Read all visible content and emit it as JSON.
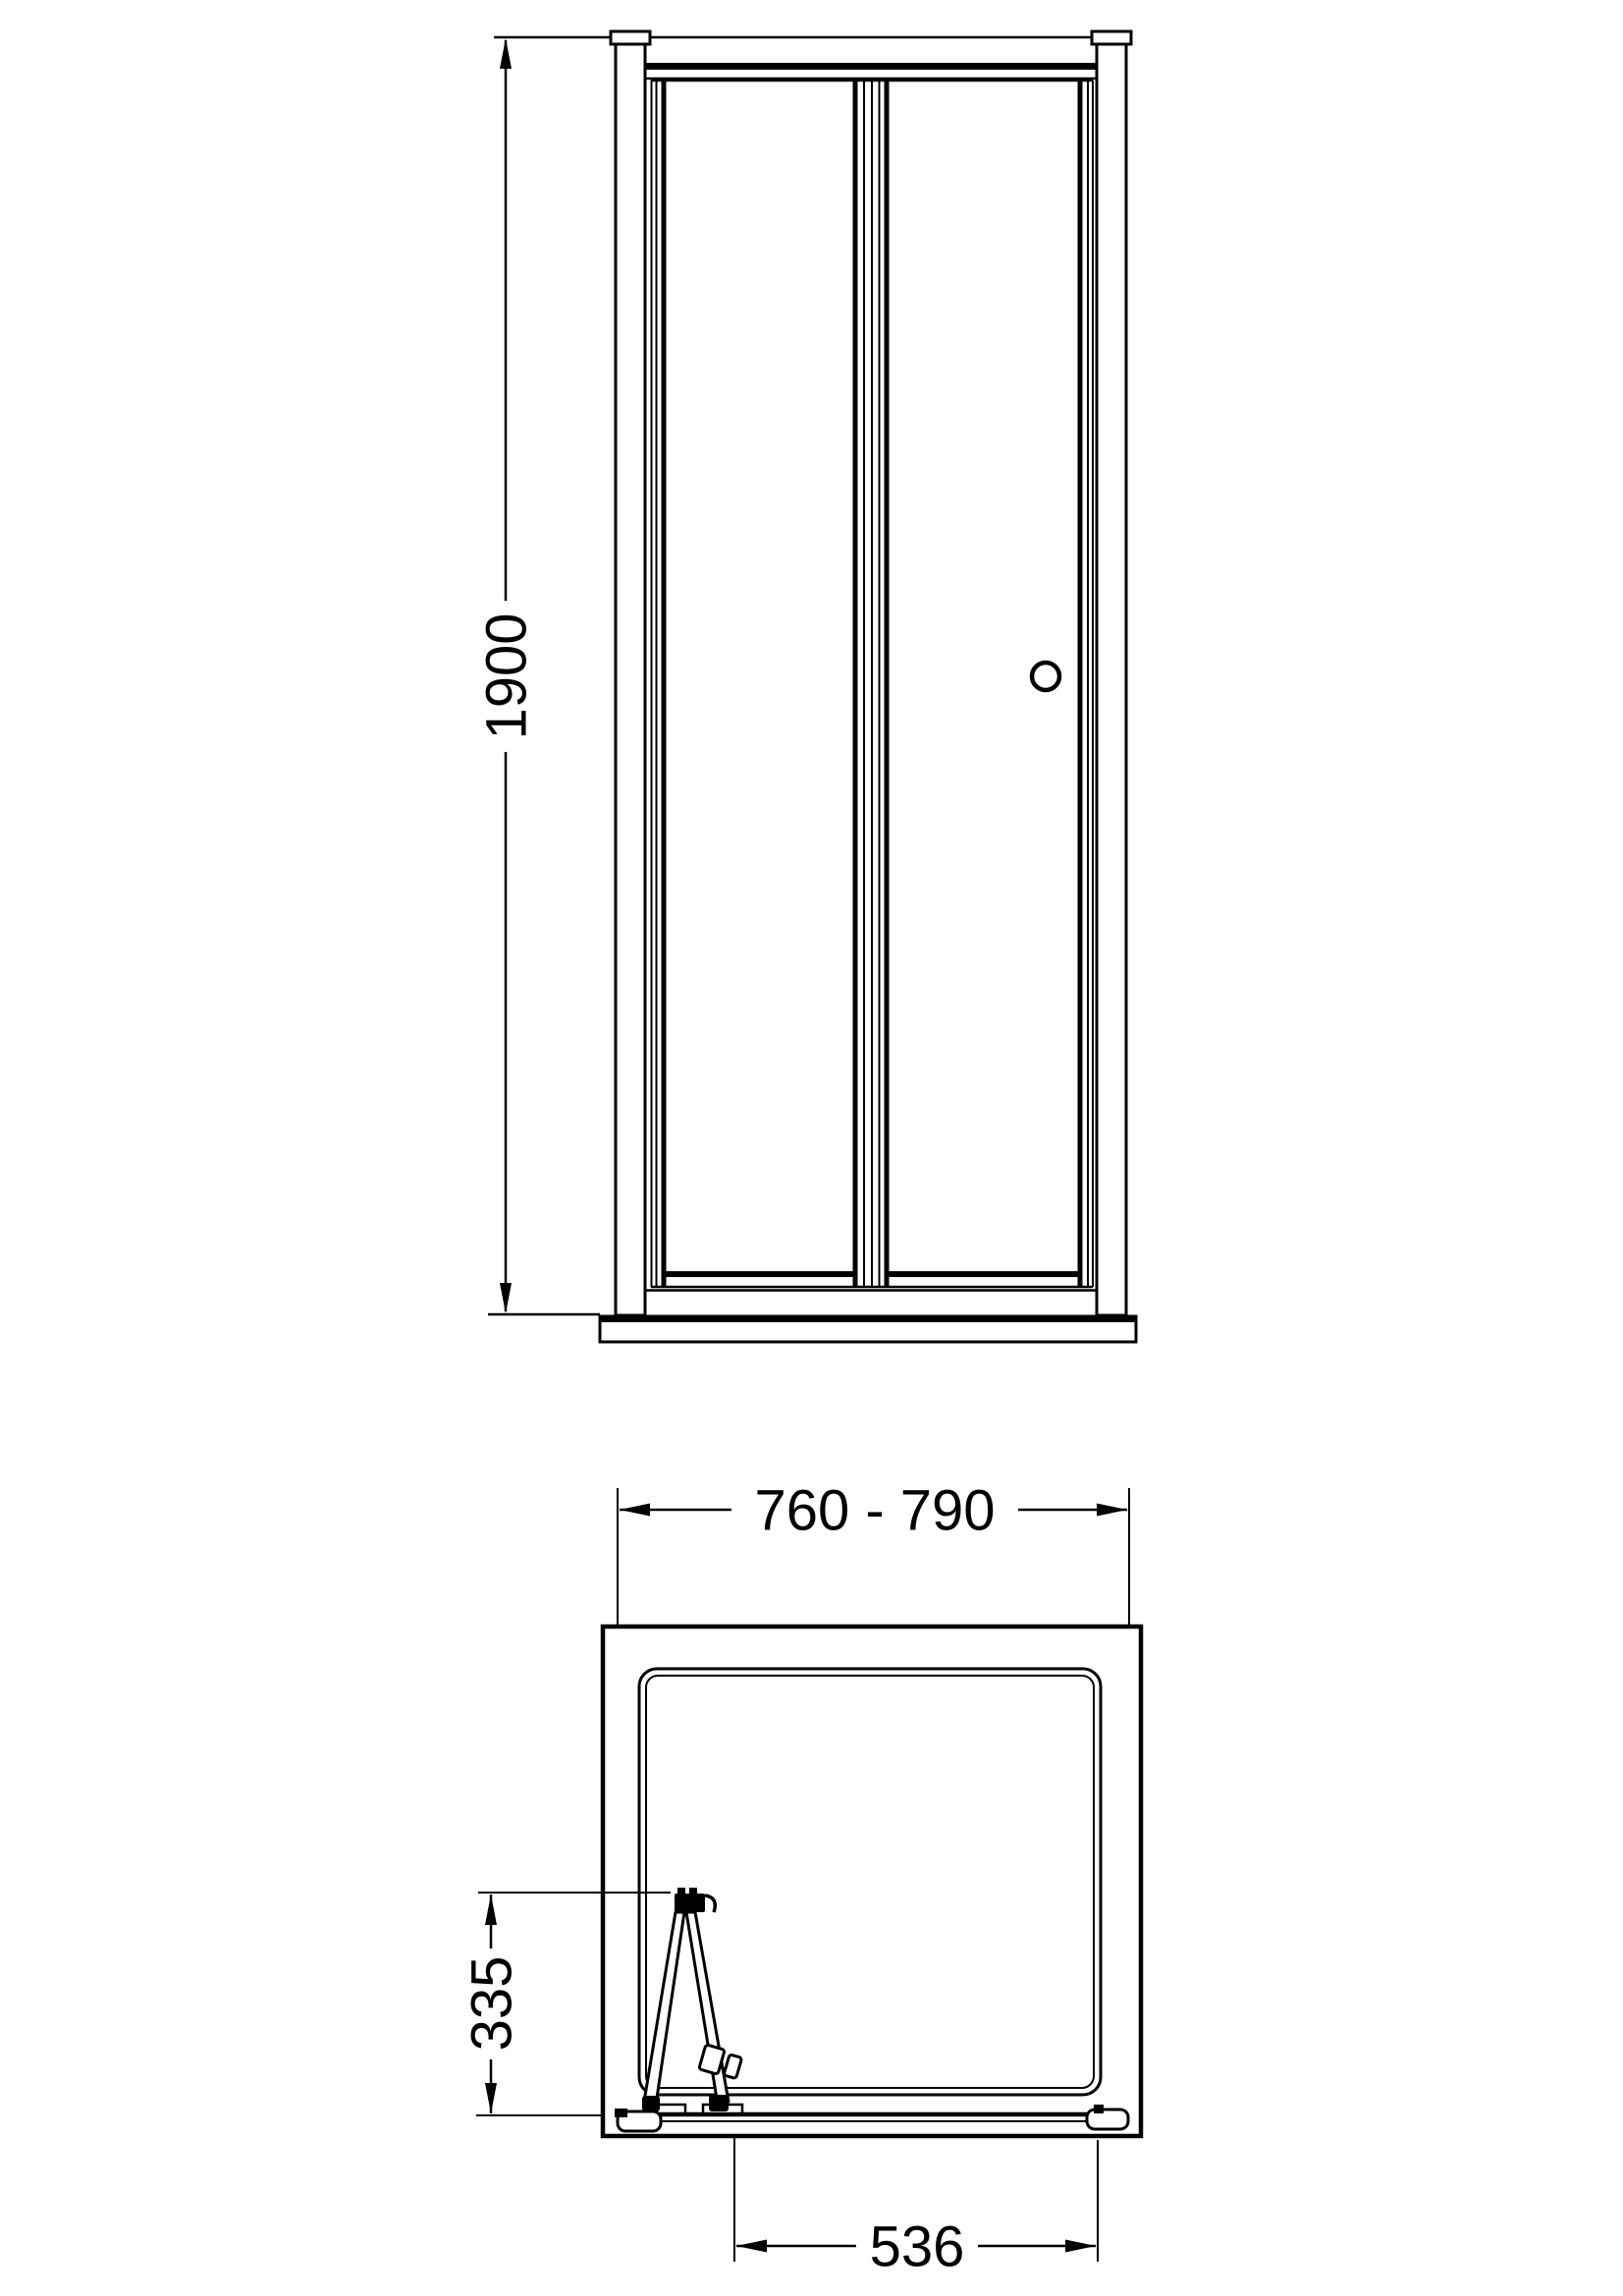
{
  "meta": {
    "title": "Bi-fold shower door technical drawing",
    "background_color": "#ffffff",
    "line_color": "#000000",
    "units": "mm"
  },
  "views": {
    "front_elevation": {
      "name": "front elevation (bi-fold door on tray)"
    },
    "plan": {
      "name": "plan view (door folded open)"
    }
  },
  "dimensions": {
    "height": "1900",
    "width_range": "760 - 790",
    "fold_projection": "335",
    "clear_opening": "536"
  }
}
